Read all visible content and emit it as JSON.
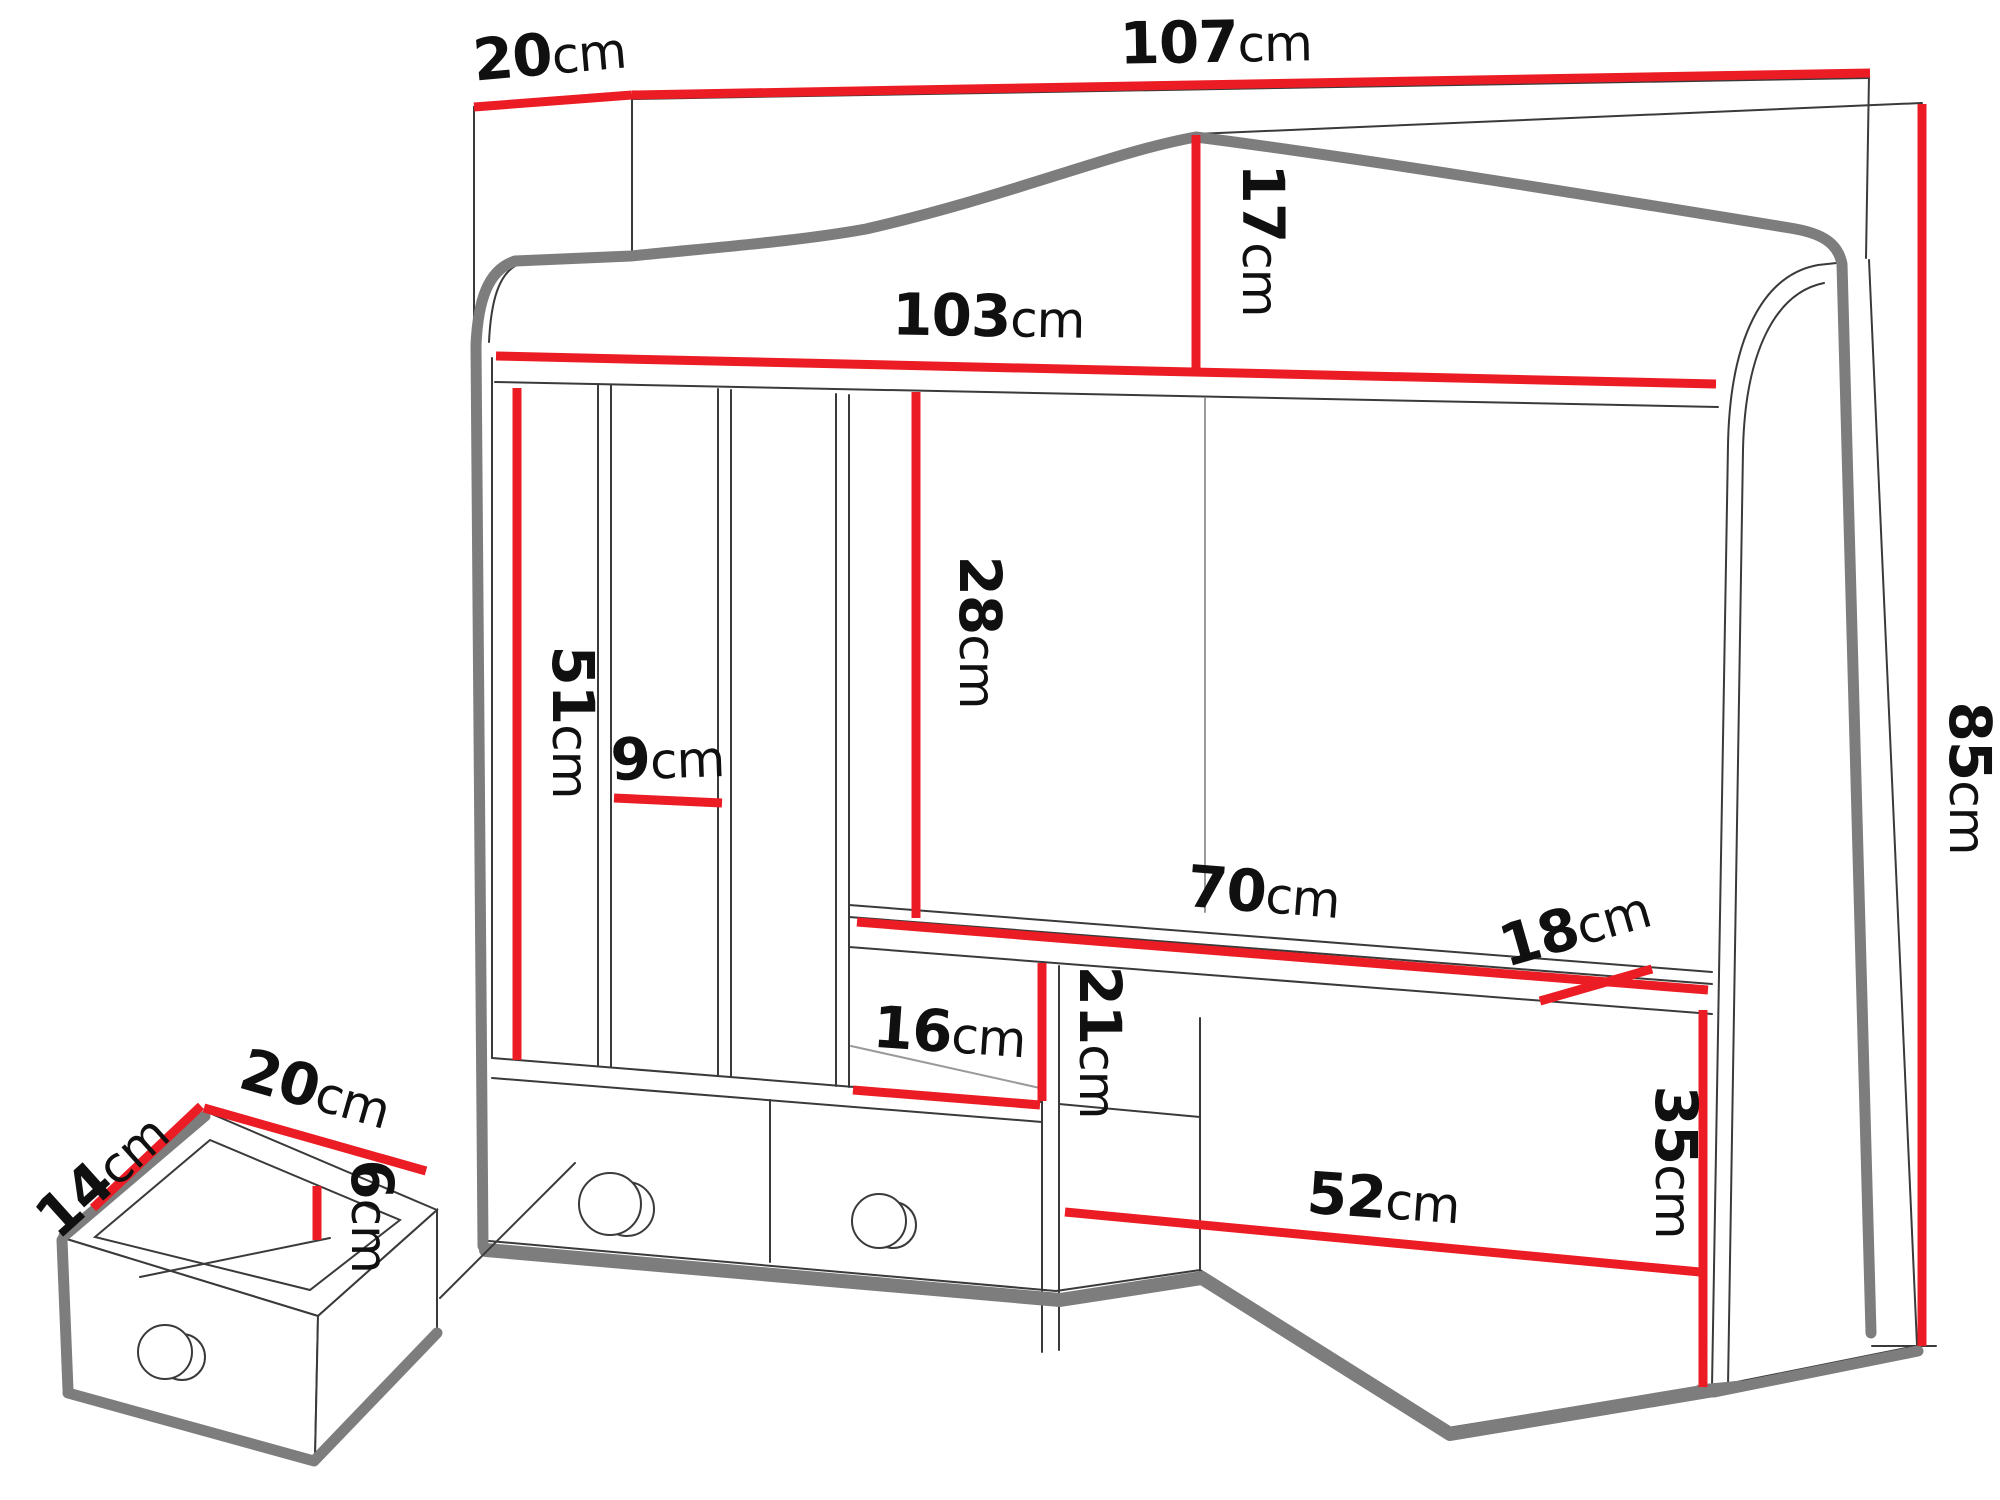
{
  "title": "Desk hutch technical dimension diagram",
  "colors": {
    "dimension": "#ec1c24",
    "outline": "#222222",
    "shadow": "#7d7d7d",
    "background": "#ffffff"
  },
  "unit_label": "cm",
  "dimensions": {
    "top_depth": {
      "value": "20",
      "unit": "cm"
    },
    "top_width": {
      "value": "107",
      "unit": "cm"
    },
    "crown_height": {
      "value": "17",
      "unit": "cm"
    },
    "inner_width": {
      "value": "103",
      "unit": "cm"
    },
    "slot_height": {
      "value": "51",
      "unit": "cm"
    },
    "slot_width": {
      "value": "9",
      "unit": "cm"
    },
    "shelf_drop": {
      "value": "28",
      "unit": "cm"
    },
    "shelf_width": {
      "value": "70",
      "unit": "cm"
    },
    "shelf_depth": {
      "value": "18",
      "unit": "cm"
    },
    "ledge_depth": {
      "value": "16",
      "unit": "cm"
    },
    "gap_height": {
      "value": "21",
      "unit": "cm"
    },
    "total_height": {
      "value": "85",
      "unit": "cm"
    },
    "opening_width": {
      "value": "52",
      "unit": "cm"
    },
    "opening_height": {
      "value": "35",
      "unit": "cm"
    },
    "drawer_depth": {
      "value": "14",
      "unit": "cm"
    },
    "drawer_width": {
      "value": "20",
      "unit": "cm"
    },
    "drawer_height": {
      "value": "6",
      "unit": "cm"
    }
  }
}
